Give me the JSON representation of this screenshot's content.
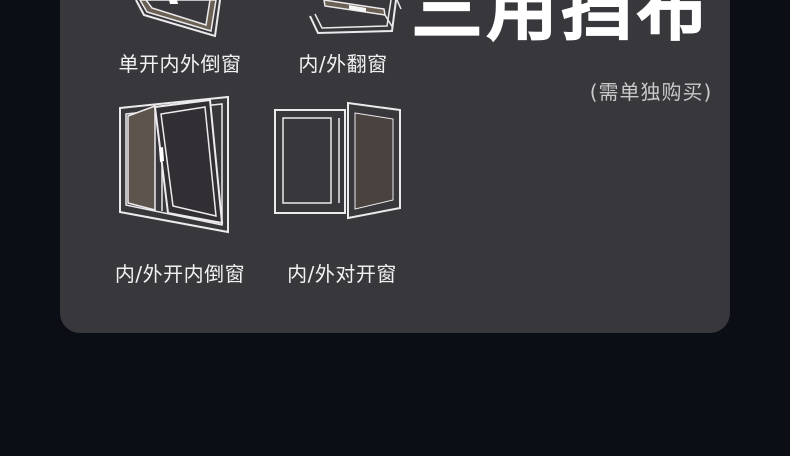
{
  "title": {
    "text": "三用挡布",
    "note": "(需单独购买)"
  },
  "window_types": [
    {
      "id": "single-tilt-window",
      "label": "单开内外倒窗"
    },
    {
      "id": "top-hung-window",
      "label": "内/外翻窗"
    },
    {
      "id": "tilt-turn-window",
      "label": "内/外开内倒窗"
    },
    {
      "id": "casement-window",
      "label": "内/外对开窗"
    }
  ],
  "colors": {
    "background": "#0b0e15",
    "panel": "#38373c",
    "outline": "#eceaec",
    "glass_brown": "#5d544d",
    "glass_dark_brown": "#4a423e",
    "title": "#ffffff",
    "note": "#c9c8ca"
  }
}
